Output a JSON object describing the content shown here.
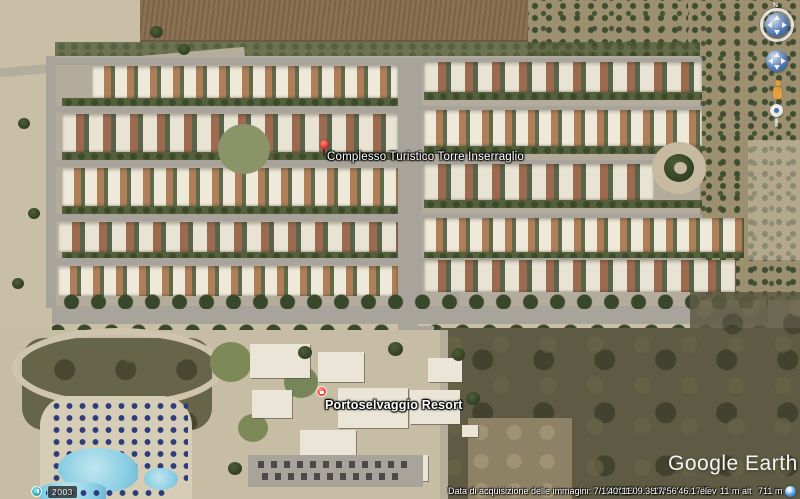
{
  "placemarks": [
    {
      "label": "Complesso Turistico Torre Inserraglio"
    },
    {
      "label": "Portoselvaggio Resort"
    }
  ],
  "watermark": "Google Earth",
  "navigation": {
    "compass_north": "N"
  },
  "historical_imagery": {
    "year": "2003"
  },
  "status_bar": {
    "imagery_date": "Data di acquisizione delle immagini: 7/19/2015",
    "latitude": "40°11'09.38\"N",
    "longitude": "17°56'46.17\"E",
    "elevation_label": "elev",
    "elevation": "11 m",
    "eye_alt_label": "alt",
    "eye_alt": "711 m"
  },
  "colors": {
    "placemark_red": "#e03c31",
    "poi_pin_red": "#e8554d",
    "nav_sphere_blue": "#4a76b8",
    "pool_blue": "#86cce2",
    "streaming_blue": "#1d71c9"
  }
}
